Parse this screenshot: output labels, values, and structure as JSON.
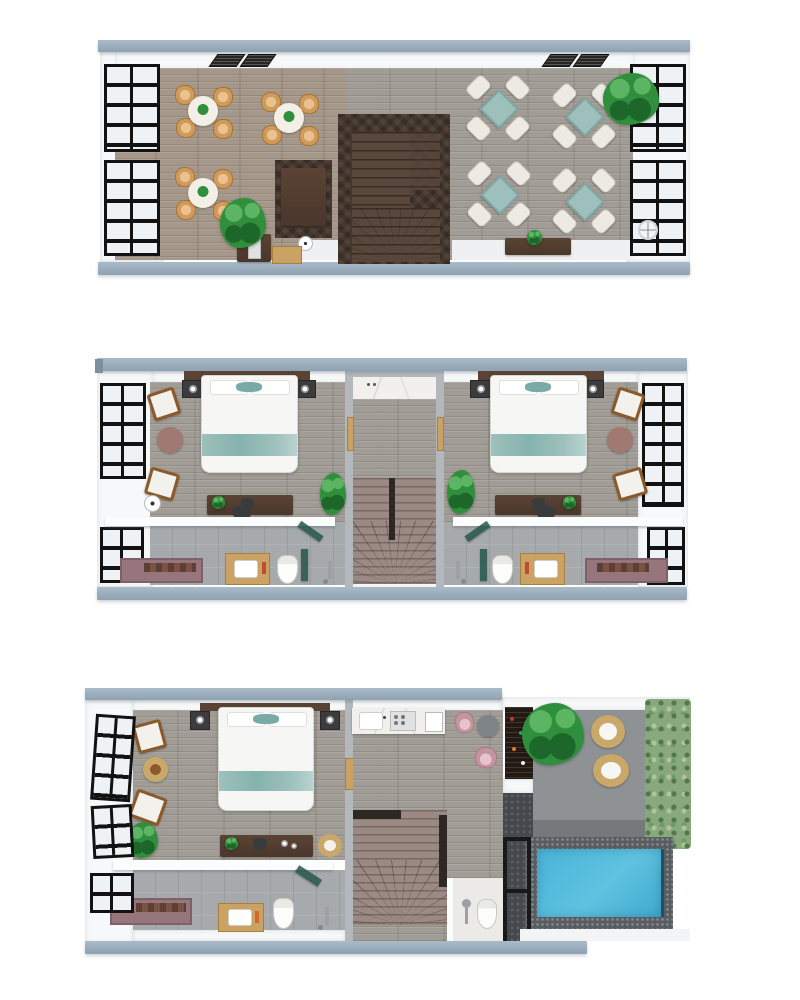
{
  "scene": {
    "type": "architectural-3d-floor-plan",
    "view": "top-down dollhouse render of a three-storey townhouse",
    "visible_text": "",
    "floors": [
      {
        "id": "top-floor",
        "use": "restaurant-lounge",
        "areas": [
          "dining area with three round tables and rattan chairs",
          "lounge area with four cross bench seating groups",
          "reception desk on dark herringbone wood",
          "dark wood U-stair",
          "coffee station",
          "sideboard console",
          "potted plants",
          "full-height black framed windows",
          "roof vents"
        ]
      },
      {
        "id": "middle-floor",
        "use": "two mirrored bedroom suites",
        "areas": [
          "left bedroom with double bed, desk, lounge chairs, ottoman, floor lamp",
          "left en-suite bathroom with vanity, toilet, glass shower, mauve bench",
          "central core with marble landing, corridor and staircase",
          "right bedroom (mirrored)",
          "right en-suite bathroom (mirrored)",
          "black framed windows both sides"
        ]
      },
      {
        "id": "ground-floor",
        "use": "bedroom suite with kitchen, terrace and plunge pool",
        "areas": [
          "bedroom with double bed, desk, lounge chairs, jute rug",
          "en-suite bathroom",
          "kitchenette with marble counter, sink and cooktop",
          "dining nook with round table and two pink chairs",
          "slatted bar shelf",
          "staircase with winders",
          "powder room with toilet and shower",
          "terrace with two round rattan chairs",
          "vertical garden green wall",
          "large potted plant",
          "plunge pool with stone surround",
          "black pergola frame"
        ]
      }
    ]
  },
  "palette": {
    "beam": "#a9bac8",
    "beam_dark": "#8fa2b2",
    "wall": "#f7f8f9",
    "wall_gray": "#b3b8bc",
    "wood_a": "#a19d96",
    "wood_warm_a": "#a5988a",
    "tile_a": "#a6aaad",
    "marble": "#f2f0ed",
    "wood_dark": "#44362d",
    "wood_dark_hi": "#5a4334",
    "stair_a": "#9b8a83",
    "stair_dark_a": "#5a473c",
    "teal": "#9dc0bc",
    "teal_dark": "#79aaa6",
    "bed": "#f6f6f4",
    "tan": "#cf9a5c",
    "tan_dark": "#a8732f",
    "tanv": "#c9a264",
    "seat_white": "#eceae2",
    "mauve": "#96767c",
    "pink": "#c495a0",
    "pool": "#49b4d8",
    "stone": "#585d62",
    "stone_dark": "#45484c",
    "plant": "#2f8f3c",
    "plant_dark": "#1d672a",
    "plant_light": "#5cb563",
    "hedge": "#8aa87e",
    "hedge_dark": "#4f7a48",
    "terrace": "#8e9295",
    "jute": "#c9a86a"
  }
}
